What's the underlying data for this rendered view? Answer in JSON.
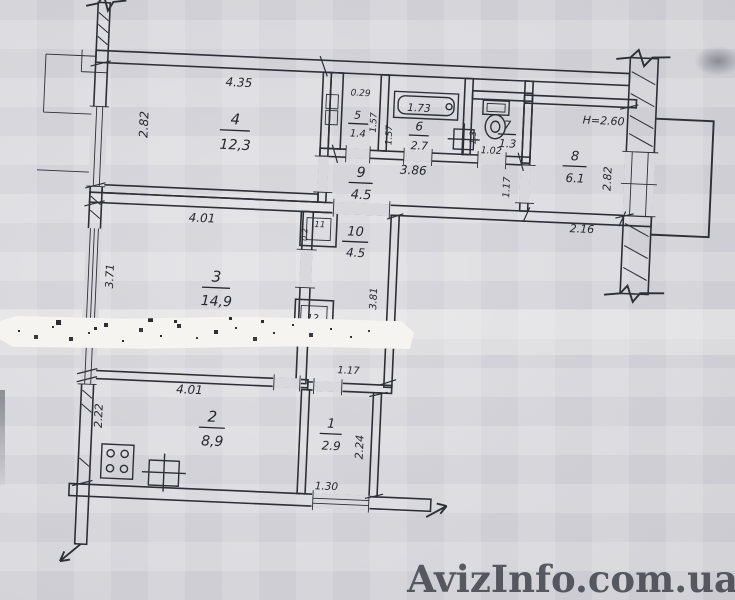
{
  "watermark": "AvizInfo.com.ua",
  "plan": {
    "ceiling_height_note": "H=2.60",
    "rooms": {
      "r1": {
        "num": "1",
        "area": "2.9"
      },
      "r2": {
        "num": "2",
        "area": "8,9"
      },
      "r3": {
        "num": "3",
        "area": "14,9"
      },
      "r4": {
        "num": "4",
        "area": "12,3"
      },
      "r5": {
        "num": "5",
        "area": "1.4"
      },
      "r6": {
        "num": "6",
        "area": "2.7"
      },
      "r7": {
        "num": "7",
        "area": "1.3"
      },
      "r8": {
        "num": "8",
        "area": "6.1"
      },
      "r9": {
        "num": "9",
        "area": "4.5"
      },
      "r10": {
        "num": "10",
        "area": "4.5"
      },
      "r11": {
        "num": "11",
        "area": "0.2"
      },
      "r12": {
        "num": "12"
      }
    },
    "dims": {
      "room4_width": "4.35",
      "room4_left": "2.82",
      "duct": "0.29",
      "room5_depth": "1.57",
      "room6_depth": "1.57",
      "bathtub": "1.73",
      "room7_left": "1.3",
      "room7_width": "1.02",
      "hall_width": "3.86",
      "room8_right": "2.82",
      "room8_bottom": "2.16",
      "room8_door": "1.17",
      "room3_width": "4.01",
      "room3_left": "3.71",
      "corridor_depth": "3.81",
      "passage_width": "1.17",
      "room2_width": "4.01",
      "room2_left": "2.22",
      "room1_right": "2.24",
      "room1_bottom": "1.30"
    }
  }
}
